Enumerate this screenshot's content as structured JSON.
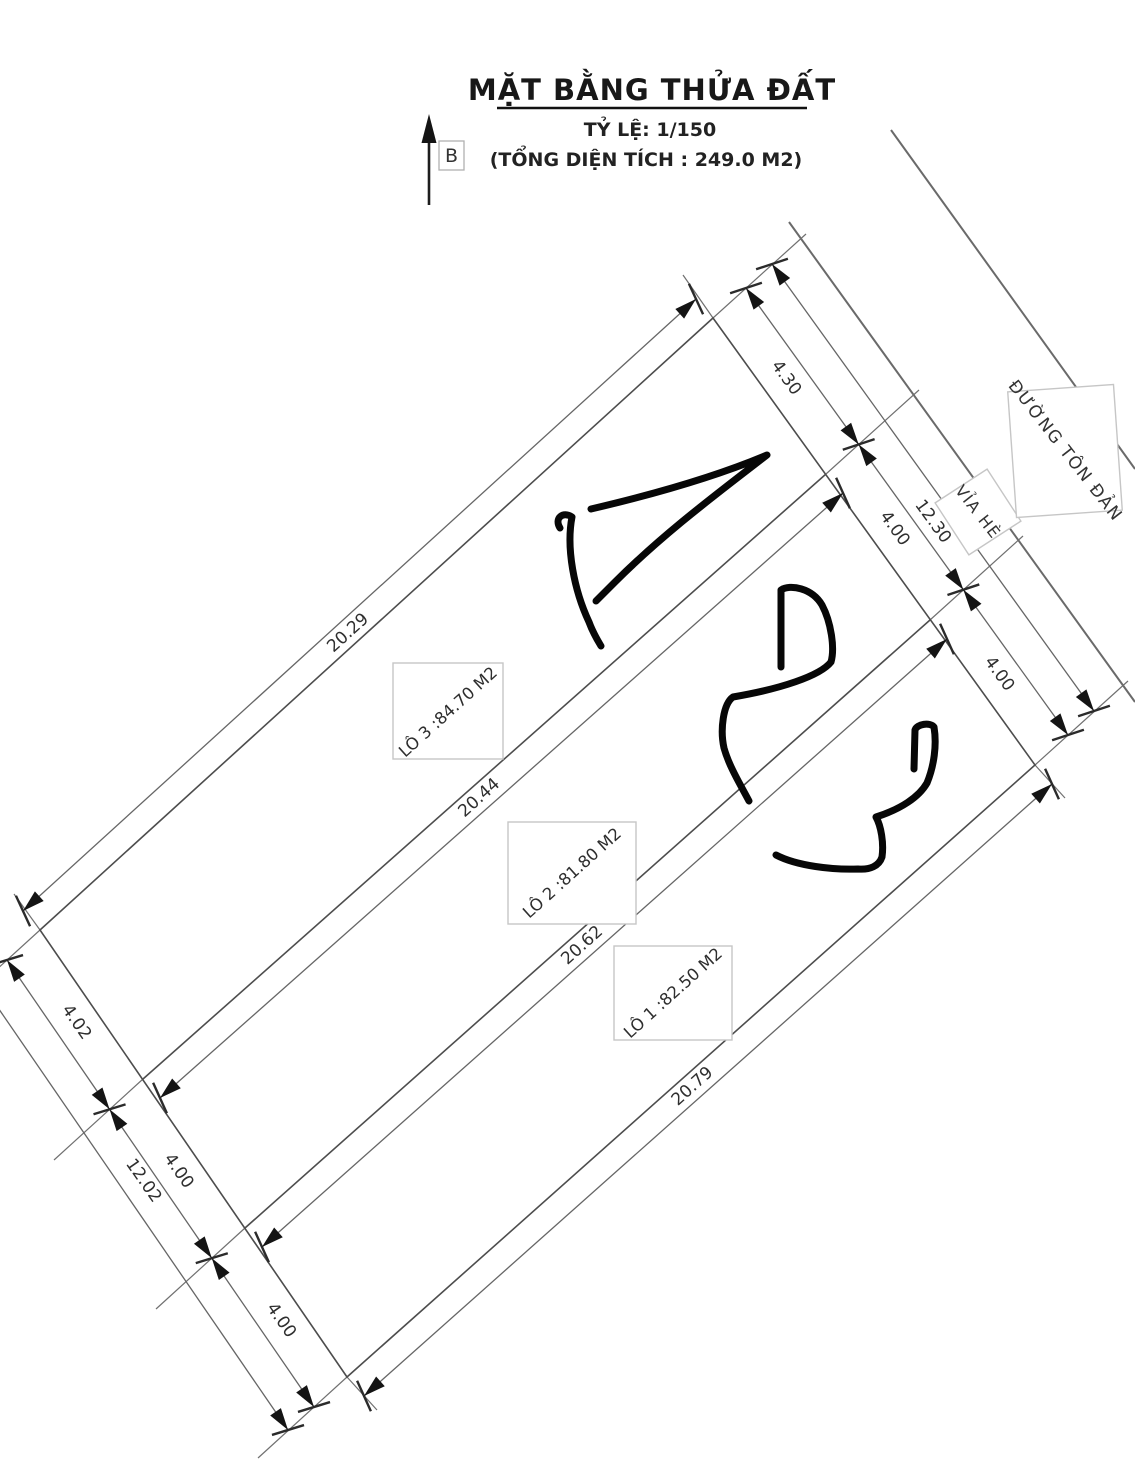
{
  "header": {
    "title": "MẶT BẰNG THỬA ĐẤT",
    "scale": "TỶ LỆ: 1/150",
    "total_area": "(TỔNG DIỆN TÍCH : 249.0 M2)",
    "north_label": "B"
  },
  "road": {
    "name": "ĐƯỜNG TÔN ĐẢN",
    "sidewalk": "VỈA HÈ"
  },
  "plots": [
    {
      "label": "LÔ 1 :82.50 M2"
    },
    {
      "label": "LÔ 2 :81.80 M2"
    },
    {
      "label": "LÔ 3 :84.70 M2"
    }
  ],
  "dims": {
    "long": [
      "20.29",
      "20.44",
      "20.62",
      "20.79"
    ],
    "back_total": "12.02",
    "back_segments": [
      "4.02",
      "4.00",
      "4.00"
    ],
    "front_total": "12.30",
    "front_segments": [
      "4.30",
      "4.00",
      "4.00"
    ]
  }
}
